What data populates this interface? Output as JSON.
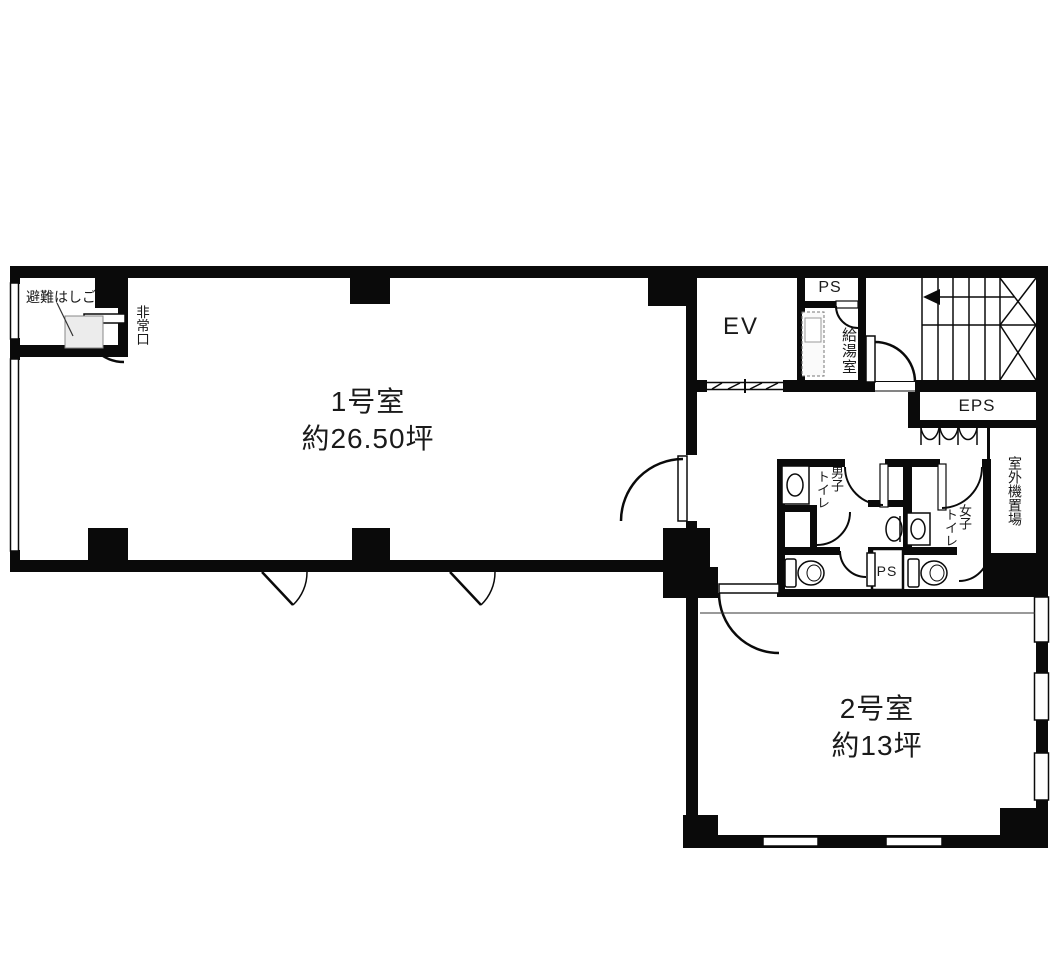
{
  "title": "floor plan",
  "rooms": {
    "room1": {
      "name": "1号室",
      "area": "約26.50坪"
    },
    "room2": {
      "name": "2号室",
      "area": "約13坪"
    }
  },
  "core": {
    "elevator": "EV",
    "pipe_space_upper": "PS",
    "kitchenette": "給湯室",
    "eps": "EPS",
    "pipe_space_lower": "PS",
    "outdoor_unit": "室外機置場"
  },
  "toilets": {
    "mens": {
      "line1": "男子",
      "line2": "トイレ"
    },
    "womens": {
      "line1": "女子",
      "line2": "トイレ"
    }
  },
  "evacuation": {
    "ladder": "避難はしご",
    "exit": "非常口"
  },
  "colors": {
    "wall": "#0a0a0a",
    "background": "#ffffff",
    "hatch_fill": "#ececec"
  }
}
